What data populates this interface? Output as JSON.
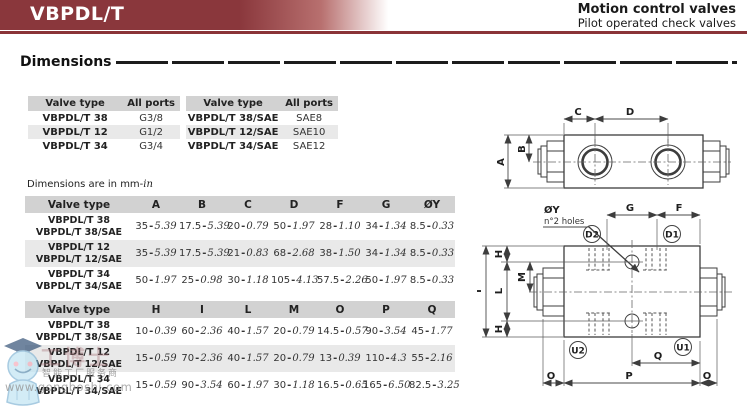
{
  "header": {
    "product": "VBPDL/T",
    "title": "Motion control valves",
    "subtitle": "Pilot operated check valves"
  },
  "section": {
    "title": "Dimensions"
  },
  "units_note": {
    "prefix": "Dimensions are in mm-",
    "unit": "in"
  },
  "colors": {
    "brand_red": "#8a3438",
    "table_header_bg": "#d2d2d2",
    "table_alt_bg": "#e9e9e9"
  },
  "port_tables": [
    {
      "headers": [
        "Valve type",
        "All ports"
      ],
      "rows": [
        [
          "VBPDL/T 38",
          "G3/8"
        ],
        [
          "VBPDL/T 12",
          "G1/2"
        ],
        [
          "VBPDL/T 34",
          "G3/4"
        ]
      ]
    },
    {
      "headers": [
        "Valve type",
        "All ports"
      ],
      "rows": [
        [
          "VBPDL/T 38/SAE",
          "SAE8"
        ],
        [
          "VBPDL/T 12/SAE",
          "SAE10"
        ],
        [
          "VBPDL/T 34/SAE",
          "SAE12"
        ]
      ]
    }
  ],
  "dim_table_1": {
    "headers": [
      "Valve type",
      "A",
      "B",
      "C",
      "D",
      "F",
      "G",
      "ØY"
    ],
    "rows": [
      {
        "name": [
          "VBPDL/T 38",
          "VBPDL/T 38/SAE"
        ],
        "values": [
          [
            "35",
            "5.39"
          ],
          [
            "17.5",
            "5.39"
          ],
          [
            "20",
            "0.79"
          ],
          [
            "50",
            "1.97"
          ],
          [
            "28",
            "1.10"
          ],
          [
            "34",
            "1.34"
          ],
          [
            "8.5",
            "0.33"
          ]
        ]
      },
      {
        "name": [
          "VBPDL/T 12",
          "VBPDL/T 12/SAE"
        ],
        "values": [
          [
            "35",
            "5.39"
          ],
          [
            "17.5",
            "5.39"
          ],
          [
            "21",
            "0.83"
          ],
          [
            "68",
            "2.68"
          ],
          [
            "38",
            "1.50"
          ],
          [
            "34",
            "1.34"
          ],
          [
            "8.5",
            "0.33"
          ]
        ]
      },
      {
        "name": [
          "VBPDL/T 34",
          "VBPDL/T 34/SAE"
        ],
        "values": [
          [
            "50",
            "1.97"
          ],
          [
            "25",
            "0.98"
          ],
          [
            "30",
            "1.18"
          ],
          [
            "105",
            "4.13"
          ],
          [
            "57.5",
            "2.26"
          ],
          [
            "50",
            "1.97"
          ],
          [
            "8.5",
            "0.33"
          ]
        ]
      }
    ]
  },
  "dim_table_2": {
    "headers": [
      "Valve type",
      "H",
      "I",
      "L",
      "M",
      "O",
      "P",
      "Q"
    ],
    "rows": [
      {
        "name": [
          "VBPDL/T 38",
          "VBPDL/T 38/SAE"
        ],
        "values": [
          [
            "10",
            "0.39"
          ],
          [
            "60",
            "2.36"
          ],
          [
            "40",
            "1.57"
          ],
          [
            "20",
            "0.79"
          ],
          [
            "14.5",
            "0.57"
          ],
          [
            "90",
            "3.54"
          ],
          [
            "45",
            "1.77"
          ]
        ]
      },
      {
        "name": [
          "VBPDL/T 12",
          "VBPDL/T 12/SAE"
        ],
        "values": [
          [
            "15",
            "0.59"
          ],
          [
            "70",
            "2.36"
          ],
          [
            "40",
            "1.57"
          ],
          [
            "20",
            "0.79"
          ],
          [
            "13",
            "0.39"
          ],
          [
            "110",
            "4.3"
          ],
          [
            "55",
            "2.16"
          ]
        ]
      },
      {
        "name": [
          "VBPDL/T 34",
          "VBPDL/T 34/SAE"
        ],
        "values": [
          [
            "15",
            "0.59"
          ],
          [
            "90",
            "3.54"
          ],
          [
            "60",
            "1.97"
          ],
          [
            "30",
            "1.18"
          ],
          [
            "16.5",
            "0.65"
          ],
          [
            "165",
            "6.50"
          ],
          [
            "82.5",
            "3.25"
          ]
        ]
      }
    ]
  },
  "drawing": {
    "labels": {
      "A": "A",
      "B": "B",
      "C": "C",
      "D": "D",
      "G": "G",
      "F": "F",
      "H": "H",
      "I": "I",
      "L": "L",
      "M": "M",
      "O": "O",
      "P": "P",
      "Q": "Q",
      "OY": "ØY",
      "holes": "n°2 holes",
      "D1": "D1",
      "D2": "D2",
      "U1": "U1",
      "U2": "U2"
    }
  },
  "watermark": {
    "brand": "工博士",
    "tagline": "智能工厂服务商",
    "url": "www.gongboshi.com"
  }
}
